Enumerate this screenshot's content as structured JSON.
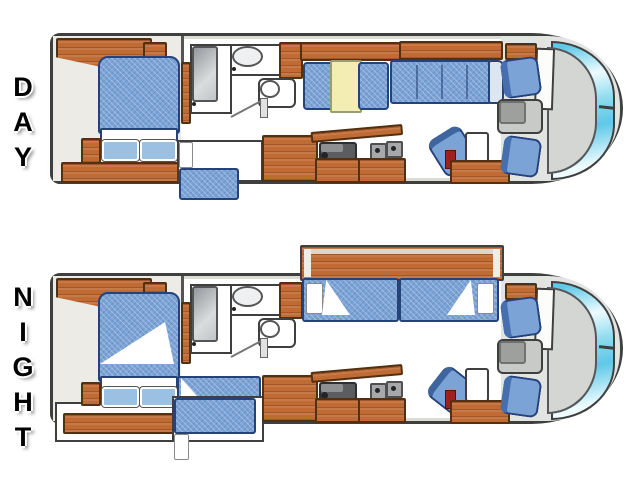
{
  "labels": {
    "day": "DAY",
    "night": "NIGHT"
  },
  "colors": {
    "outline": "#3f3f3f",
    "wall": "#dcdbd4",
    "floor": "#ffffff",
    "bedroom_floor": "#edebe5",
    "cockpit_floor": "#e2e4e2",
    "wood": "#c06a34",
    "wood_border": "#53300f",
    "cushion": "#7ba3d6",
    "cushion_border": "#26427a",
    "cushion_seam": "#4a6fa5",
    "table_yellow": "#f3edb4",
    "glass_cyan": "#5ec8e6",
    "glass_white": "#eefbff",
    "console_gray": "#c8cac8",
    "dash_gray": "#d3d6d3",
    "counter_dark": "#5b5d5f",
    "accent_red": "#a02020"
  },
  "plans": [
    {
      "id": "day",
      "label": "DAY",
      "features": [
        "overhead-cabinets",
        "queen-bed",
        "pillows",
        "nightstand",
        "dresser",
        "shower",
        "lavatory-sink",
        "toilet",
        "bath-door",
        "sofa-bunk",
        "pantry-cabinet",
        "kitchen-sink",
        "stove-burners",
        "counter-base-cabinets",
        "dinette-bench",
        "dinette-table",
        "sofa",
        "barrel-chair",
        "end-table",
        "entry-step",
        "driver-seat",
        "passenger-seat",
        "engine-console",
        "dash-panel",
        "windshield"
      ]
    },
    {
      "id": "night",
      "label": "NIGHT",
      "features": [
        "overhead-cabinets",
        "queen-bed-extended",
        "turned-down-blanket",
        "pillows",
        "nightstand",
        "dresser-slide-out",
        "shower",
        "lavatory-sink",
        "toilet",
        "bath-door",
        "bunk-bed-pulled-out",
        "pantry-cabinet",
        "kitchen-sink",
        "stove-burners",
        "counter-base-cabinets",
        "slide-out-roof",
        "dinette-converted-bed",
        "sofa-converted-bed",
        "barrel-chair",
        "end-table",
        "entry-step",
        "driver-seat",
        "passenger-seat",
        "engine-console",
        "dash-panel",
        "windshield"
      ]
    }
  ]
}
